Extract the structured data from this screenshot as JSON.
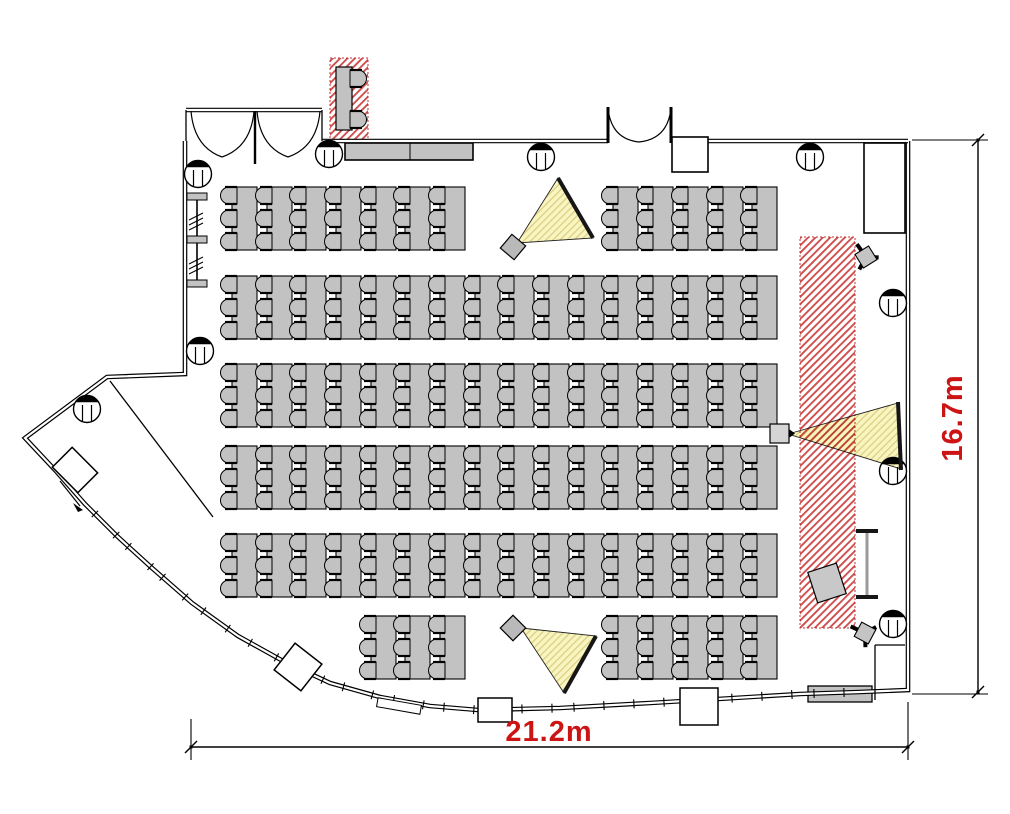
{
  "meta": {
    "drawing_type": "floor-plan",
    "room": "seminar-room-theater-layout"
  },
  "labels": {
    "width": "21.2m",
    "height": "16.7m"
  },
  "colors": {
    "accent_red": "#CC1414",
    "hatch_line": "#D05050",
    "hatch_border": "#C03030",
    "beam_fill_bg": "#F9F5C1",
    "beam_hatch_line": "#DCCF84",
    "furniture_gray": "#C2C2C2",
    "wall_black": "#000000",
    "screen_dark": "#161616"
  },
  "canvas": {
    "w": 1010,
    "h": 814
  },
  "tables": {
    "w": 25,
    "h": 63,
    "chair": {
      "w": 14,
      "h": 17,
      "dx": -9,
      "offsets": [
        0,
        23,
        46
      ]
    },
    "rows": [
      {
        "y": 187,
        "xs": [
          232,
          267,
          301,
          336,
          371,
          405,
          440,
          613,
          648,
          683,
          718,
          752
        ]
      },
      {
        "y": 276,
        "xs": [
          232,
          267,
          301,
          336,
          371,
          405,
          440,
          475,
          509,
          544,
          579,
          613,
          648,
          683,
          718,
          752
        ]
      },
      {
        "y": 364,
        "xs": [
          232,
          267,
          301,
          336,
          371,
          405,
          440,
          475,
          509,
          544,
          579,
          613,
          648,
          683,
          718,
          752
        ]
      },
      {
        "y": 446,
        "xs": [
          232,
          267,
          301,
          336,
          371,
          405,
          440,
          475,
          509,
          544,
          579,
          613,
          648,
          683,
          718,
          752
        ]
      },
      {
        "y": 534,
        "xs": [
          232,
          267,
          301,
          336,
          371,
          405,
          440,
          475,
          509,
          544,
          579,
          613,
          648,
          683,
          718,
          752
        ]
      },
      {
        "y": 616,
        "xs": [
          371,
          405,
          440,
          613,
          648,
          683,
          718,
          752
        ]
      }
    ]
  },
  "stage_hatch": {
    "x": 800,
    "y": 237,
    "w": 55,
    "h": 391
  },
  "reception": {
    "hatch": {
      "x": 330,
      "y": 58,
      "w": 38,
      "h": 82
    },
    "desk": {
      "x": 336,
      "y": 67,
      "w": 16,
      "h": 63
    },
    "chairs": [
      {
        "x": 350,
        "y": 70
      },
      {
        "x": 350,
        "y": 111
      }
    ]
  },
  "counter": {
    "x": 345,
    "y": 143,
    "w": 128,
    "h": 17,
    "divider_x": 410
  },
  "console": {
    "x": 808,
    "y": 686,
    "w": 64,
    "h": 16
  },
  "av_room": {
    "x": 864,
    "y": 143,
    "w": 41,
    "h": 90
  },
  "whiteboard": {
    "x": 856,
    "w": 22,
    "cap_h": 4,
    "y_top": 529,
    "y_bottom": 595
  },
  "equipment_box": {
    "cx": 827,
    "cy": 583,
    "w": 30,
    "h": 32,
    "rot": -18
  },
  "pier_box": {
    "cx": 298,
    "cy": 667,
    "w": 34,
    "h": 34,
    "rot": 38
  },
  "bay_box": {
    "cx": 75,
    "cy": 470,
    "w": 36,
    "h": 28,
    "rot": 45
  },
  "top_wall_box": {
    "x": 672,
    "y": 137,
    "w": 36,
    "h": 35
  },
  "vestibules": [
    {
      "x": 478,
      "y": 698,
      "w": 34,
      "h": 24
    },
    {
      "x": 680,
      "y": 688,
      "w": 38,
      "h": 37
    }
  ],
  "glass_door_rect": {
    "cx": 399,
    "cy": 706,
    "w": 44,
    "h": 9,
    "rot": 10
  },
  "coat_rack": {
    "line_x": 197,
    "y1": 196,
    "y2": 287,
    "bar_x": 187,
    "bar_w": 20,
    "bar_h": 7,
    "bar_ys": [
      193,
      236,
      280
    ],
    "squiggle_ys": [
      213,
      257
    ]
  },
  "columns": [
    [
      198,
      174
    ],
    [
      329,
      154
    ],
    [
      541,
      157
    ],
    [
      810,
      157
    ],
    [
      200,
      351
    ],
    [
      87,
      409
    ],
    [
      893,
      303
    ],
    [
      893,
      471
    ],
    [
      893,
      624
    ]
  ],
  "column_r": 13.5,
  "walls": {
    "outer_path": "M185,141 L185,374 L107,377 L25,438 L55,470 L85,504 L118,537 L152,568 L192,603 L238,636 L283,661 L330,683 L380,697 L430,706 L478,710 L560,708 L650,703 L718,699 L800,694 L860,692 L908,690 L908,141",
    "double_lines": [
      [
        322,
        141,
        608,
        141
      ],
      [
        708,
        141,
        908,
        141
      ],
      [
        186,
        110,
        322,
        110
      ]
    ],
    "thin_lines": [
      [
        186,
        110,
        186,
        141
      ],
      [
        322,
        110,
        322,
        141
      ],
      [
        905,
        645,
        875,
        645
      ],
      [
        875,
        645,
        875,
        700
      ],
      [
        110,
        381,
        213,
        517
      ]
    ],
    "arrow": {
      "x1": 60,
      "y1": 481,
      "x2": 80,
      "y2": 506
    },
    "glass_pts": [
      [
        85,
        504
      ],
      [
        118,
        537
      ],
      [
        152,
        568
      ],
      [
        192,
        603
      ],
      [
        238,
        636
      ],
      [
        283,
        661
      ],
      [
        330,
        683
      ],
      [
        380,
        697
      ],
      [
        430,
        706
      ],
      [
        478,
        710
      ],
      [
        560,
        708
      ],
      [
        650,
        703
      ],
      [
        718,
        699
      ],
      [
        800,
        694
      ],
      [
        860,
        692
      ]
    ]
  },
  "doors": {
    "left_arcs": [
      "M191,111 Q194,147 222,157",
      "M222,157 Q251,147 254,111",
      "M257,111 Q260,147 288,157",
      "M288,157 Q317,147 320,111"
    ],
    "left_post": [
      255,
      111,
      255,
      164
    ],
    "right_arcs": [
      "M608,108 Q611,139 639,142",
      "M639,142 Q668,139 671,108"
    ],
    "right_posts": [
      [
        608,
        107,
        608,
        143
      ],
      [
        671,
        107,
        671,
        143
      ]
    ]
  },
  "beams": [
    {
      "pts": [
        [
          517,
          243
        ],
        [
          558,
          178
        ],
        [
          593,
          238
        ]
      ],
      "screen": [
        [
          558,
          178
        ],
        [
          593,
          238
        ]
      ]
    },
    {
      "pts": [
        [
          788,
          434
        ],
        [
          898,
          403
        ],
        [
          901,
          469
        ]
      ],
      "screen": [
        [
          898,
          402
        ],
        [
          901,
          470
        ]
      ]
    },
    {
      "pts": [
        [
          521,
          628
        ],
        [
          596,
          636
        ],
        [
          564,
          693
        ]
      ],
      "screen": [
        [
          596,
          636
        ],
        [
          564,
          693
        ]
      ]
    }
  ],
  "cone_projectors": [
    {
      "cx": 513,
      "cy": 247,
      "size": 18,
      "rot": 40
    },
    {
      "cx": 513,
      "cy": 628,
      "size": 18,
      "rot": 45
    }
  ],
  "box_projector": {
    "x": 770,
    "y": 424,
    "w": 19,
    "h": 19
  },
  "tripods": [
    {
      "cx": 866,
      "cy": 257,
      "rot": 20
    },
    {
      "cx": 865,
      "cy": 633,
      "rot": -10
    }
  ],
  "dims": {
    "bottom": {
      "x1": 191,
      "x2": 908,
      "y": 747,
      "ext": [
        [
          191,
          719,
          191,
          760
        ],
        [
          908,
          702,
          908,
          760
        ]
      ],
      "label_x": 549,
      "label_y": 741
    },
    "right": {
      "x": 978,
      "y1": 140,
      "y2": 692,
      "ext": [
        [
          912,
          140,
          988,
          140
        ],
        [
          912,
          694,
          988,
          694
        ]
      ],
      "label_x": 962,
      "label_y": 418
    }
  }
}
